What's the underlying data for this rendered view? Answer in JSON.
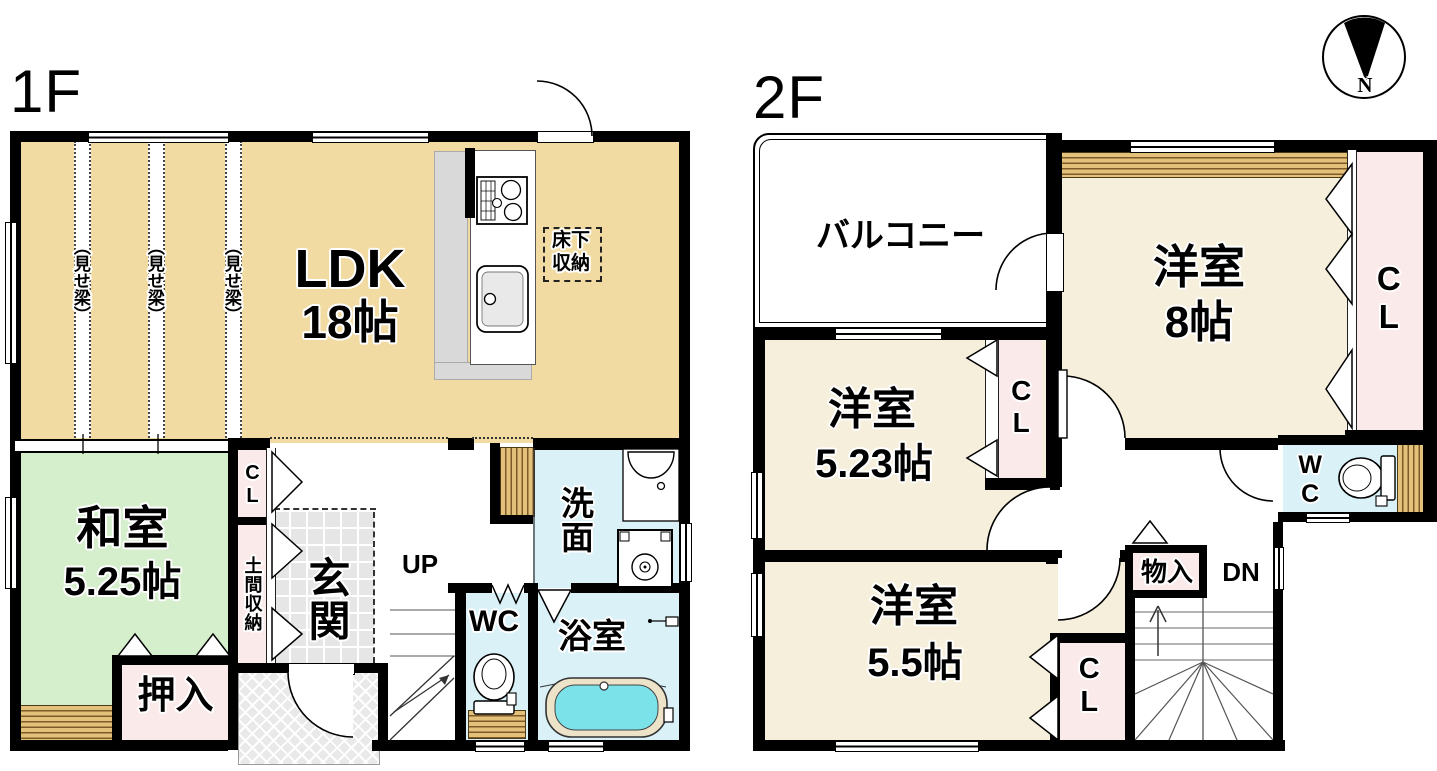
{
  "titles": {
    "floor1": "1F",
    "floor2": "2F"
  },
  "compass": {
    "north": "N"
  },
  "floor1": {
    "ldk_name": "LDK",
    "ldk_size": "18帖",
    "beam": "（見せ梁）",
    "underfloor": "床下収納",
    "washitsu_name": "和室",
    "washitsu_size": "5.25帖",
    "oshiire": "押入",
    "closet": "CL",
    "doma": "土間収納",
    "genkan": "玄関",
    "up": "UP",
    "wc": "WC",
    "senmen": "洗面",
    "bath": "浴室"
  },
  "floor2": {
    "balcony": "バルコニー",
    "room8_name": "洋室",
    "room8_size": "8帖",
    "room523_name": "洋室",
    "room523_size": "5.23帖",
    "room55_name": "洋室",
    "room55_size": "5.5帖",
    "closet": "CL",
    "wc": "WC",
    "monoire": "物入",
    "dn": "DN"
  },
  "colors": {
    "wall": "#000000",
    "ldk": "#F2DBA2",
    "tatami": "#D5EFCD",
    "western_room": "#F6EFDC",
    "closet_pink": "#FBEAEA",
    "wet_area_blue": "#D9F1F7",
    "bath_water": "#7CE2EA",
    "wood_light": "#E3C17A",
    "wood_dark": "#7D5A28",
    "tile_gray": "#E6E6E6"
  }
}
